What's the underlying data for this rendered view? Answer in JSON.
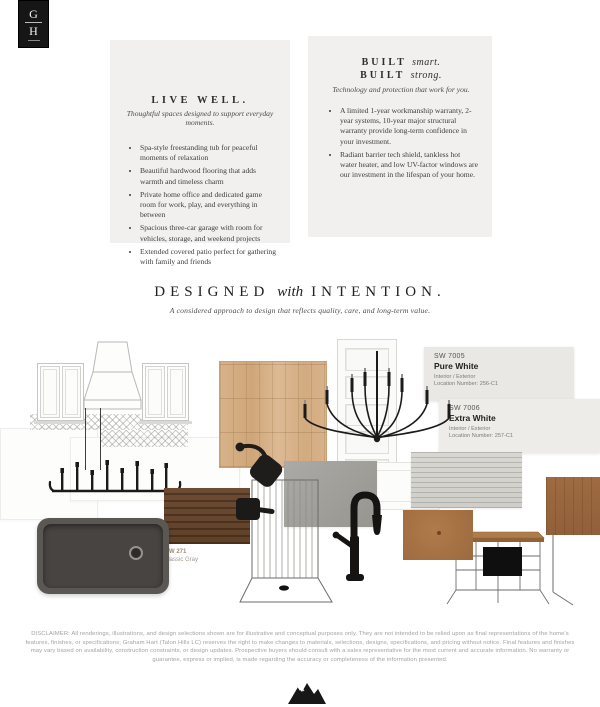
{
  "logo": {
    "letter_top": "G",
    "letter_bottom": "H"
  },
  "cards": {
    "live_well": {
      "title": "LIVE WELL.",
      "subtitle": "Thoughtful spaces designed to support everyday moments.",
      "bullets": [
        "Spa-style freestanding tub for peaceful moments of relaxation",
        "Beautiful hardwood flooring that adds warmth and timeless charm",
        "Private home office and dedicated game room for work, play, and everything in between",
        "Spacious three-car garage with room for vehicles, storage, and weekend projects",
        "Extended covered patio perfect for gathering with family and friends"
      ]
    },
    "built": {
      "line1_label": "BUILT",
      "line1_word": "smart.",
      "line2_label": "BUILT",
      "line2_word": "strong.",
      "subtitle": "Technology and protection that work for you.",
      "bullets": [
        "A limited 1-year workmanship warranty, 2-year systems, 10-year major structural warranty provide long-term confidence in your investment.",
        "Radiant barrier tech shield, tankless hot water heater, and low UV-factor windows are our investment in the lifespan of your home."
      ]
    }
  },
  "headline": {
    "part1": "DESIGNED",
    "part2": "with",
    "part3": "INTENTION.",
    "subtitle": "A considered approach to design that reflects quality, care, and long-term value."
  },
  "board": {
    "paint_chips": [
      {
        "code": "SW 7005",
        "name": "Pure White",
        "usage": "Interior / Exterior",
        "location": "Location Number: 256-C1"
      },
      {
        "code": "SW 7006",
        "name": "Extra White",
        "usage": "Interior / Exterior",
        "location": "Location Number: 257-C1"
      }
    ],
    "sink_label": {
      "line1": "MW 271",
      "line2": "Classic Gray"
    },
    "colors": {
      "oak": "#d7b088",
      "walnut": "#6b4a33",
      "cabinet_brown": "#a87245",
      "right_wood": "#9e6b42",
      "gray_tile": "#a3a29e",
      "striped_gray": "#d6d5d0",
      "sink_gray": "#5b5753",
      "chip1_bg": "#e9e8e4",
      "chip2_bg": "#edece8",
      "card_bg": "#f1f0ee",
      "fixture_black": "#1a1a1a"
    }
  },
  "disclaimer": {
    "text": "DISCLAIMER: All renderings, illustrations, and design selections shown are for illustrative and conceptual purposes only. They are not intended to be relied upon as final representations of the home's features, finishes, or specifications; Graham Hart (Talon Hills LC) reserves the right to make changes to materials, selections, designs, specifications, and pricing without notice. Final features and finishes may vary based on availability, construction constraints, or design updates. Prospective buyers should consult with a sales representative for the most current and accurate information. No warranty or guarantee, express or implied, is made regarding the accuracy or completeness of the information presented."
  }
}
